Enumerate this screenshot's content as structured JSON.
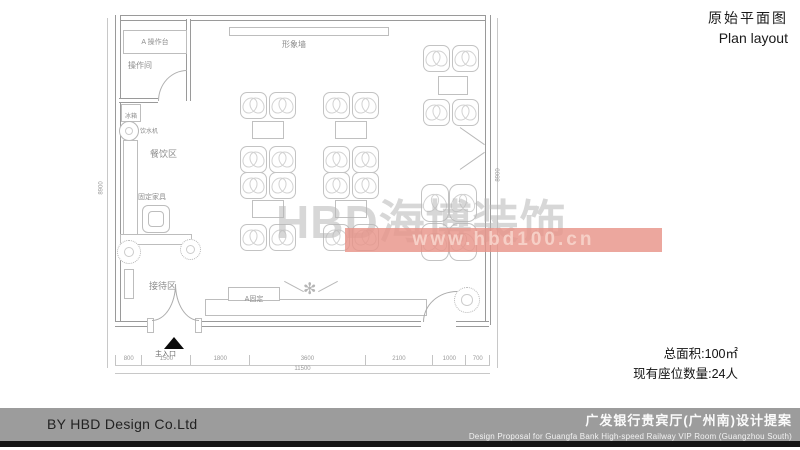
{
  "header": {
    "title_zh": "原始平面图",
    "title_en": "Plan layout"
  },
  "plan": {
    "labels": {
      "operation_counter": "A 操作台",
      "operation_room": "操作间",
      "image_wall": "形象墙",
      "fridge": "冰箱",
      "water_dispenser": "饮水机",
      "dining_area": "餐饮区",
      "fixed_furniture": "固定家具",
      "reception_area": "接待区",
      "fixed_a": "A固定",
      "main_entrance": "主入口"
    },
    "dimensions": {
      "bottom": [
        "800",
        "1500",
        "1800",
        "3600",
        "2100",
        "1000",
        "700"
      ],
      "bottom_total": "11500",
      "left": "8900",
      "right": "8900"
    }
  },
  "watermark": {
    "brand": "HBD海博装饰",
    "url": "www.hbd100.cn"
  },
  "stats": {
    "area": "总面积:100㎡",
    "seats": "现有座位数量:24人"
  },
  "footer": {
    "by": "BY  HBD Design Co.Ltd",
    "project_zh": "广发银行贵宾厅(广州南)设计提案",
    "project_en": "Design Proposal for Guangfa Bank High-speed Railway VIP Room (Guangzhou South)"
  },
  "colors": {
    "watermark_band": "#e8948a",
    "footer_bar": "#9c9c9c",
    "footer_strip": "#141414"
  }
}
